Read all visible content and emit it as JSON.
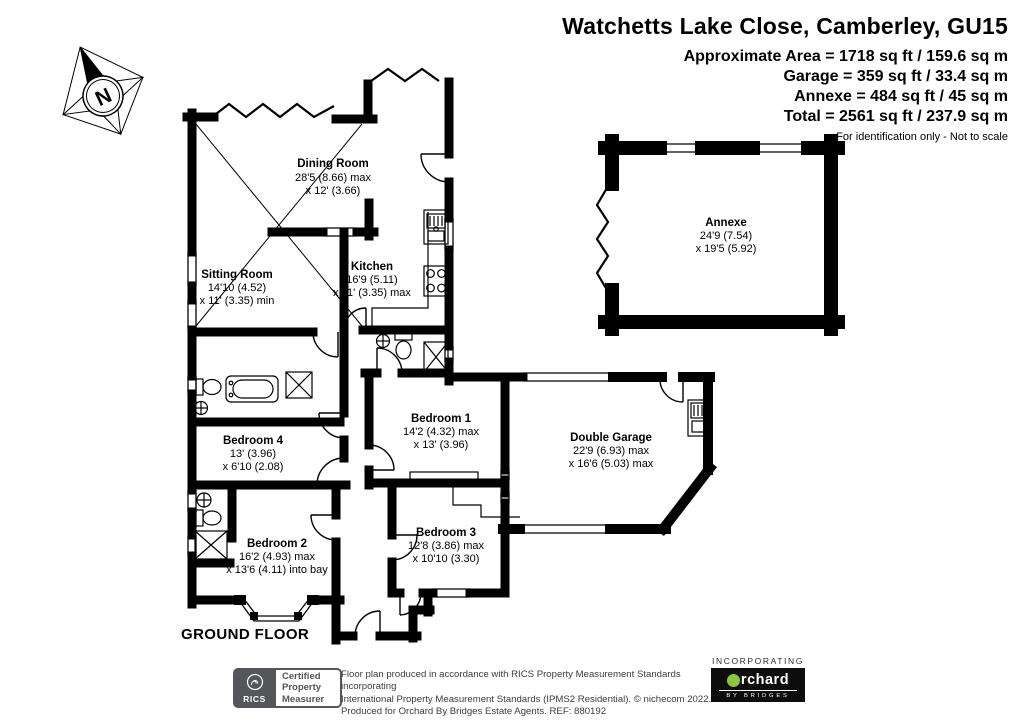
{
  "header": {
    "title": "Watchetts Lake Close, Camberley, GU15",
    "approx_area": "Approximate Area = 1718 sq ft / 159.6 sq m",
    "garage_area": "Garage = 359 sq ft / 33.4 sq m",
    "annexe_area": "Annexe = 484 sq ft / 45 sq m",
    "total_area": "Total = 2561 sq ft / 237.9 sq m",
    "disclaimer": "For identification only - Not to scale"
  },
  "compass": {
    "north_label": "N"
  },
  "floor": {
    "label": "GROUND FLOOR"
  },
  "rooms": {
    "dining": {
      "name": "Dining Room",
      "dim1": "28'5 (8.66) max",
      "dim2": "x 12' (3.66)"
    },
    "sitting": {
      "name": "Sitting Room",
      "dim1": "14'10 (4.52)",
      "dim2": "x 11' (3.35) min"
    },
    "kitchen": {
      "name": "Kitchen",
      "dim1": "16'9 (5.11)",
      "dim2": "x 11' (3.35) max"
    },
    "annexe": {
      "name": "Annexe",
      "dim1": "24'9 (7.54)",
      "dim2": "x 19'5 (5.92)"
    },
    "bedroom1": {
      "name": "Bedroom 1",
      "dim1": "14'2 (4.32) max",
      "dim2": "x 13' (3.96)"
    },
    "bedroom4": {
      "name": "Bedroom 4",
      "dim1": "13' (3.96)",
      "dim2": "x 6'10 (2.08)"
    },
    "bedroom2": {
      "name": "Bedroom 2",
      "dim1": "16'2 (4.93) max",
      "dim2": "x 13'6 (4.11) into bay"
    },
    "bedroom3": {
      "name": "Bedroom 3",
      "dim1": "12'8 (3.86) max",
      "dim2": "x 10'10 (3.30)"
    },
    "garage": {
      "name": "Double Garage",
      "dim1": "22'9 (6.93) max",
      "dim2": "x 16'6 (5.03) max"
    }
  },
  "footer": {
    "rics_label": "RICS",
    "badge_line1": "Certified",
    "badge_line2": "Property",
    "badge_line3": "Measurer",
    "line1": "Floor plan produced in accordance with RICS Property Measurement Standards incorporating",
    "line2": "International Property Measurement Standards (IPMS2 Residential).  © nichecom 2022.",
    "line3": "Produced for Orchard By Bridges Estate Agents.  REF: 880192",
    "incorporating": "INCORPORATING",
    "orchard_name": "rchard",
    "orchard_sub": "BY BRIDGES"
  },
  "colors": {
    "wall": "#000000",
    "orchard_green": "#8CC63F",
    "rics_gray": "#55565A"
  }
}
